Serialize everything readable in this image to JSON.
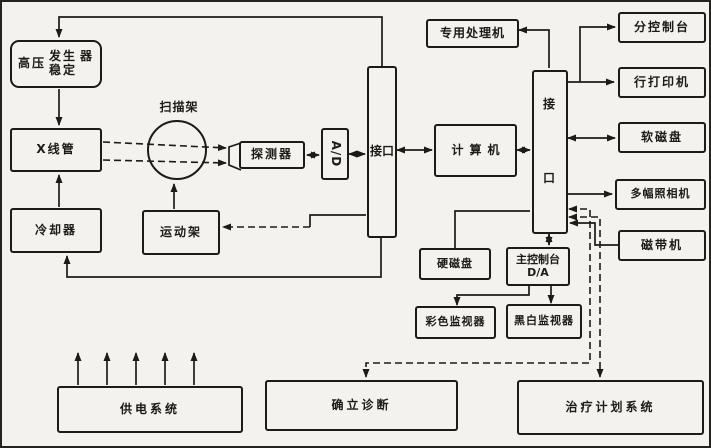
{
  "colors": {
    "ink": "#1d1b18",
    "paper": "#f3f2ee"
  },
  "diagram": {
    "hv_box": {
      "left": "高压",
      "top": "发生",
      "bottom": "稳定",
      "right": "器"
    },
    "xray_tube": "X线管",
    "cooler": "冷却器",
    "gantry": "扫描架",
    "motion_frame": "运动架",
    "detector": "探测器",
    "adc": "A/D",
    "interface1": "接口",
    "computer": "计算机",
    "special_processor": "专用处理机",
    "interface2": {
      "top": "接",
      "bottom": "口"
    },
    "sub_console": "分控制台",
    "line_printer": "行打印机",
    "floppy_disk": "软磁盘",
    "multi_camera": "多幅照相机",
    "tape_drive": "磁带机",
    "hard_disk": "硬磁盘",
    "main_console": {
      "line1": "主控制台",
      "line2": "D/A"
    },
    "color_monitor": "彩色监视器",
    "bw_monitor": "黑白监视器",
    "power_system": "供电系统",
    "diagnosis": "确立诊断",
    "treatment_planning": "治疗计划系统"
  }
}
